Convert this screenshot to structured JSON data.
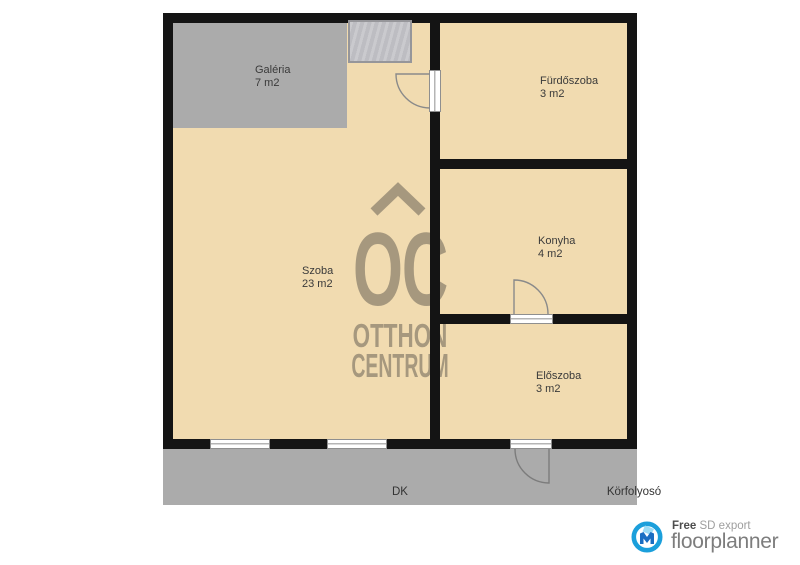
{
  "plan": {
    "rooms": [
      {
        "id": "galeria",
        "name": "Galéria",
        "area": "7 m2"
      },
      {
        "id": "szoba",
        "name": "Szoba",
        "area": "23 m2"
      },
      {
        "id": "furdoszoba",
        "name": "Fürdőszoba",
        "area": "3 m2"
      },
      {
        "id": "konyha",
        "name": "Konyha",
        "area": "4 m2"
      },
      {
        "id": "eloszoba",
        "name": "Előszoba",
        "area": "3 m2"
      }
    ],
    "corridor": {
      "orientation": "DK",
      "name": "Körfolyosó"
    }
  },
  "watermark": {
    "monogram": "OC",
    "line1": "OTTHON",
    "line2": "CENTRUM"
  },
  "branding": {
    "free_label": "Free",
    "export_label": "SD export",
    "brand_name": "floorplanner"
  },
  "colors": {
    "floor": "#f1dbb0",
    "zone": "#ababab",
    "wall": "#141414",
    "watermark": "#a6987e",
    "stairs": "#c6c6ca",
    "brand_accent": "#1b9fdb",
    "brand_text": "#7d7d7d"
  }
}
